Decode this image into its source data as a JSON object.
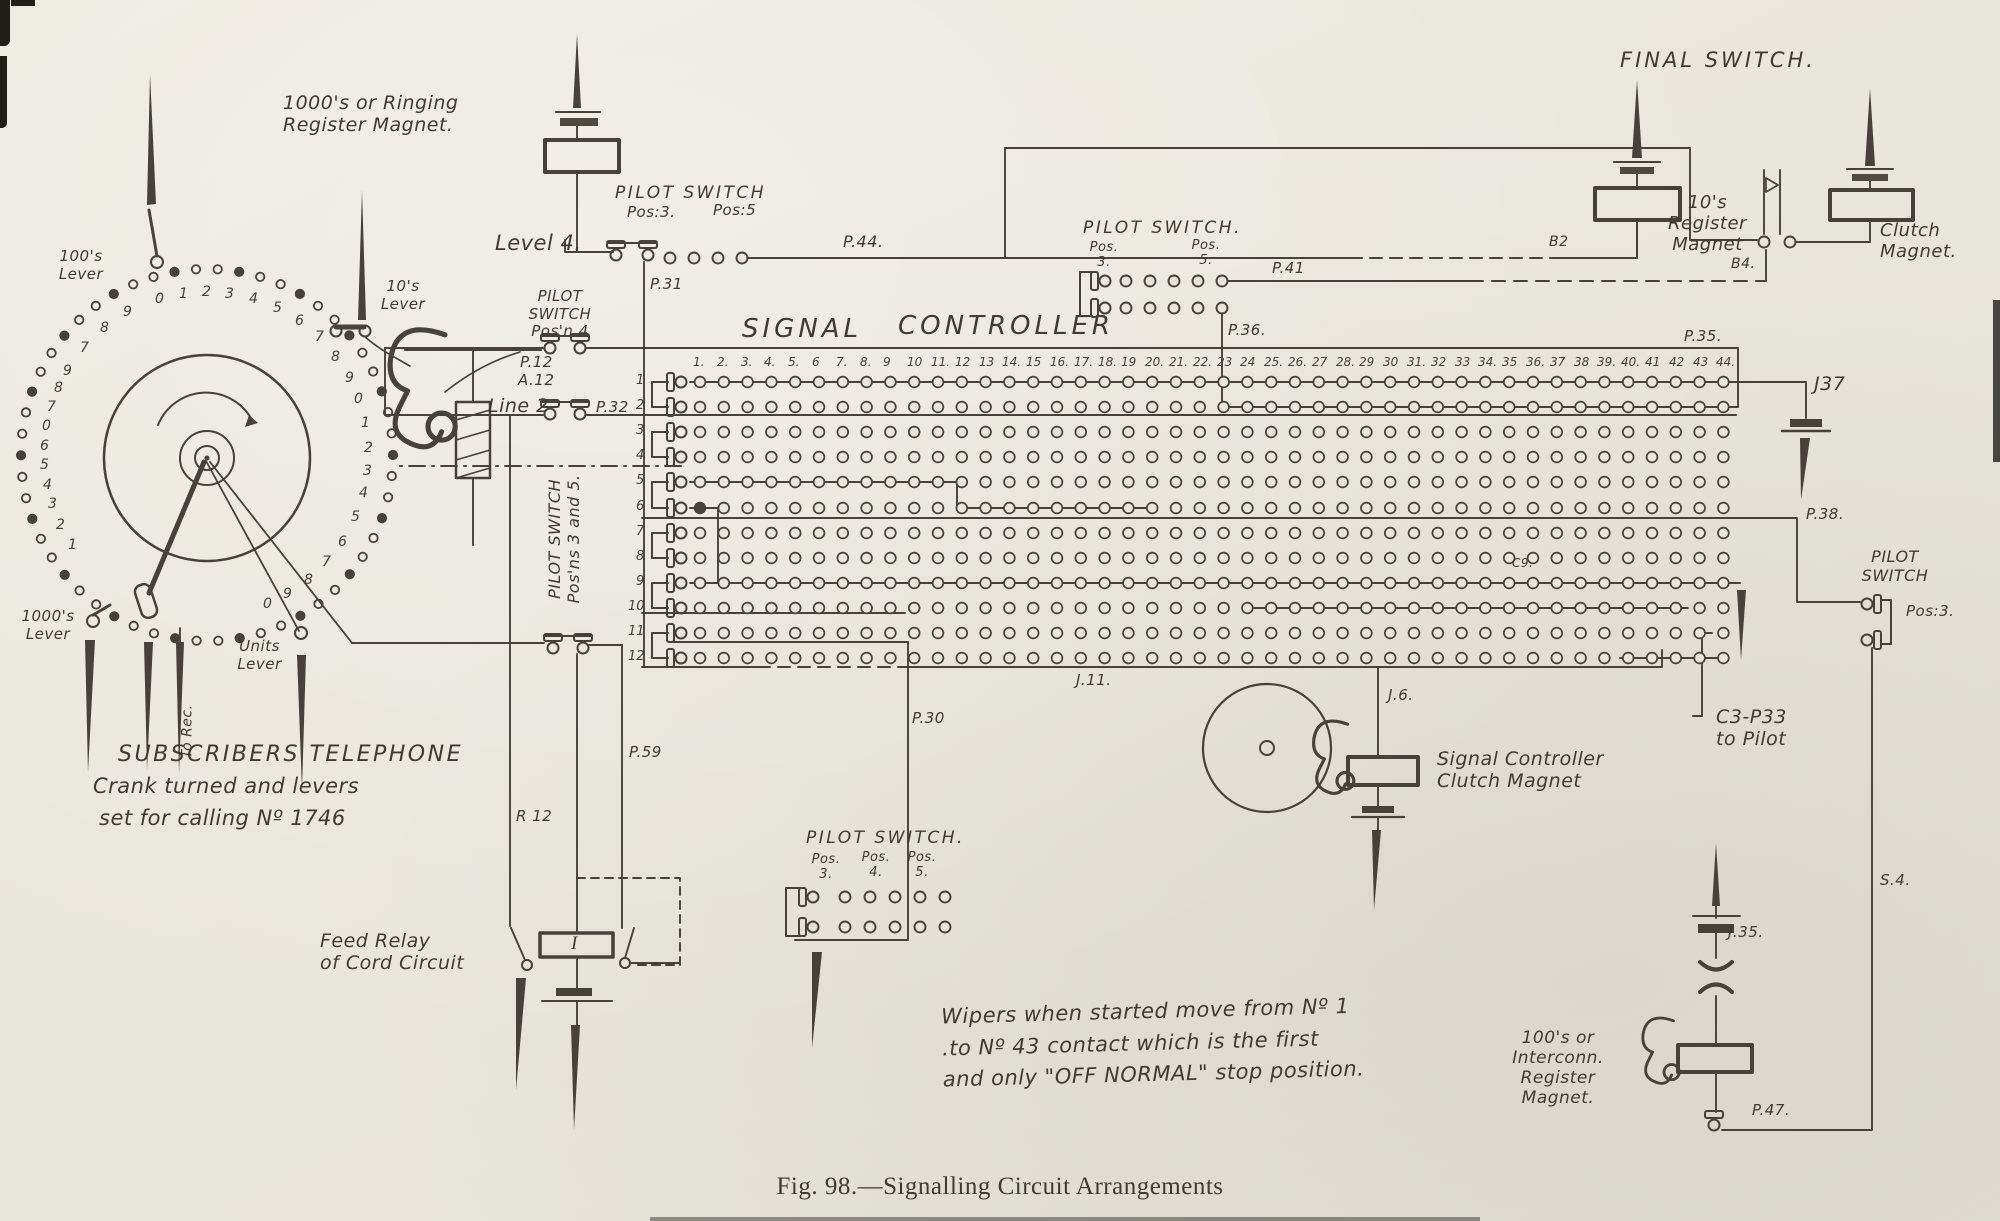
{
  "figure": {
    "caption": "Fig. 98.—Signalling Circuit Arrangements"
  },
  "title": {
    "left": "SIGNAL",
    "right": "CONTROLLER"
  },
  "colors": {
    "ink": "#46413a",
    "paper": "#e9e6dd"
  },
  "labels": {
    "ringing_magnet": "1000's or Ringing\nRegister Magnet.",
    "ps1_title": "PILOT SWITCH",
    "ps1_pos3": "Pos:3.",
    "ps1_pos5": "Pos:5",
    "level4": "Level 4.",
    "p44": "P.44.",
    "p31": "P.31",
    "ps2_title": "PILOT\nSWITCH\nPos'n 4",
    "p12": "P.12",
    "a12": "A.12",
    "line2": "Line 2",
    "p32": "P.32",
    "ps3_title": "PILOT SWITCH.",
    "ps3_pos3": "Pos.\n3.",
    "ps3_pos5": "Pos.\n5.",
    "p41": "P.41",
    "p36": "P.36.",
    "final_switch": "FINAL SWITCH.",
    "b2": "B2",
    "tens_magnet": "10's\nRegister\nMagnet",
    "b4": "B4.",
    "clutch_magnet": "Clutch\nMagnet.",
    "p35": "P.35.",
    "j37": "J37",
    "p38": "P.38.",
    "ps4_title": "PILOT\nSWITCH",
    "ps4_pos3": "Pos:3.",
    "c9": "C9.",
    "j11": "J.11.",
    "j6": "J.6.",
    "sc_clutch_magnet": "Signal Controller\nClutch Magnet",
    "c3p33": "C3-P33\nto Pilot",
    "s4": "S.4.",
    "j35": "J.35.",
    "hundreds_magnet": "100's or\nInterconn.\nRegister\nMagnet.",
    "p47": "P.47.",
    "note": "Wipers when started move from Nº 1\n.to Nº 43 contact which is the first\nand only \"OFF NORMAL\" stop position.",
    "subscribers1": "SUBSCRIBERS TELEPHONE",
    "subscribers2": "Crank turned and levers",
    "subscribers3": "set for calling Nº 1746",
    "lever_100": "100's\nLever",
    "lever_10": "10's\nLever",
    "lever_1000": "1000's\nLever",
    "lever_units": "Units\nLever",
    "to_rec": "To Rec.",
    "feed_relay": "Feed Relay\nof Cord Circuit",
    "r12": "R 12",
    "p59": "P.59",
    "p30": "P.30",
    "ps5_title": "PILOT SWITCH.",
    "ps5_pos3": "Pos.\n3.",
    "ps5_pos4": "Pos.\n4.",
    "ps5_pos5": "Pos.\n5.",
    "ps35_vertical": "PILOT SWITCH\nPos'ns 3 and 5.",
    "relay_i": "I"
  },
  "grid": {
    "columns": [
      "1.",
      "2.",
      "3.",
      "4.",
      "5.",
      "6",
      "7.",
      "8.",
      "9",
      "10",
      "11.",
      "12",
      "13",
      "14.",
      "15",
      "16.",
      "17.",
      "18.",
      "19",
      "20.",
      "21.",
      "22.",
      "23",
      "24",
      "25.",
      "26.",
      "27",
      "28.",
      "29",
      "30",
      "31.",
      "32",
      "33",
      "34.",
      "35",
      "36.",
      "37",
      "38",
      "39.",
      "40.",
      "41",
      "42",
      "43",
      "44."
    ],
    "rows": [
      "1",
      "2",
      "3",
      "4",
      "5",
      "6",
      "7",
      "8",
      "9",
      "10",
      "11",
      "12"
    ]
  },
  "telephone": {
    "digits": [
      {
        "t": "1",
        "a": 214
      },
      {
        "t": "2",
        "a": 206
      },
      {
        "t": "3",
        "a": 198
      },
      {
        "t": "4",
        "a": 191
      },
      {
        "t": "5",
        "a": 184
      },
      {
        "t": "6",
        "a": 177
      },
      {
        "t": "0",
        "a": 170
      },
      {
        "t": "7",
        "a": 163
      },
      {
        "t": "8",
        "a": 156
      },
      {
        "t": "9",
        "a": 149
      },
      {
        "t": "7",
        "a": 139
      },
      {
        "t": "8",
        "a": 129
      },
      {
        "t": "9",
        "a": 119
      },
      {
        "t": "0",
        "a": 107
      },
      {
        "t": "1",
        "a": 98
      },
      {
        "t": "2",
        "a": 90
      },
      {
        "t": "3",
        "a": 82
      },
      {
        "t": "4",
        "a": 73
      },
      {
        "t": "5",
        "a": 64
      },
      {
        "t": "6",
        "a": 55
      },
      {
        "t": "7",
        "a": 46
      },
      {
        "t": "8",
        "a": 37
      },
      {
        "t": "9",
        "a": 28
      },
      {
        "t": "0",
        "a": 20
      },
      {
        "t": "1",
        "a": 11
      },
      {
        "t": "2",
        "a": 2
      },
      {
        "t": "3",
        "a": -6
      },
      {
        "t": "4",
        "a": -14
      },
      {
        "t": "5",
        "a": -23
      },
      {
        "t": "6",
        "a": -33
      },
      {
        "t": "7",
        "a": -42
      },
      {
        "t": "8",
        "a": -51
      },
      {
        "t": "9",
        "a": -60
      },
      {
        "t": "0",
        "a": -68
      }
    ]
  }
}
